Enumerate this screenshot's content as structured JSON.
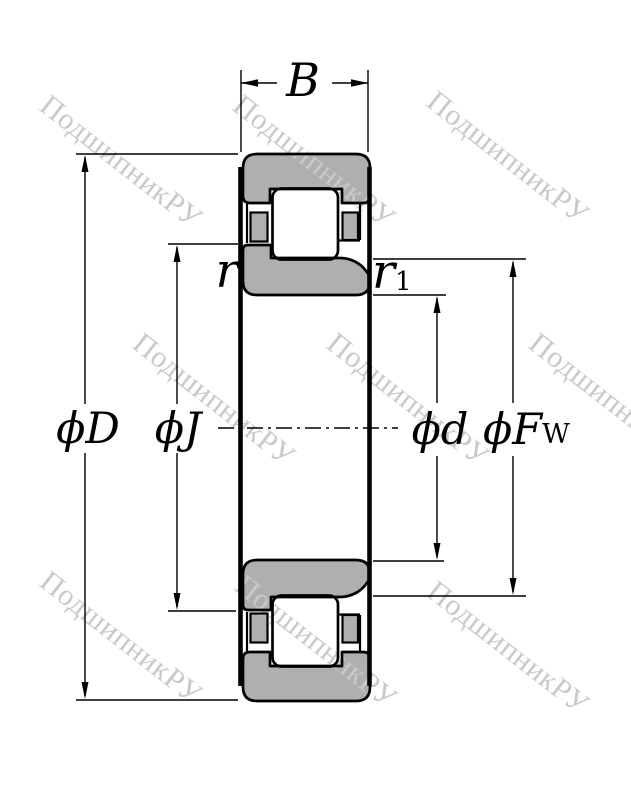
{
  "watermark": {
    "text": "ПодшипникРУ",
    "color": "#c9c9c9"
  },
  "colors": {
    "background": "#ffffff",
    "metal_fill": "#afafaf",
    "line": "#000000"
  },
  "labels": {
    "b": "B",
    "phi_D": "ϕD",
    "phi_J": "ϕJ",
    "phi_d": "ϕd",
    "phi_F": "ϕF",
    "phi_F_sub": "W",
    "r": "r",
    "r1": "r",
    "r1_sub": "1"
  }
}
